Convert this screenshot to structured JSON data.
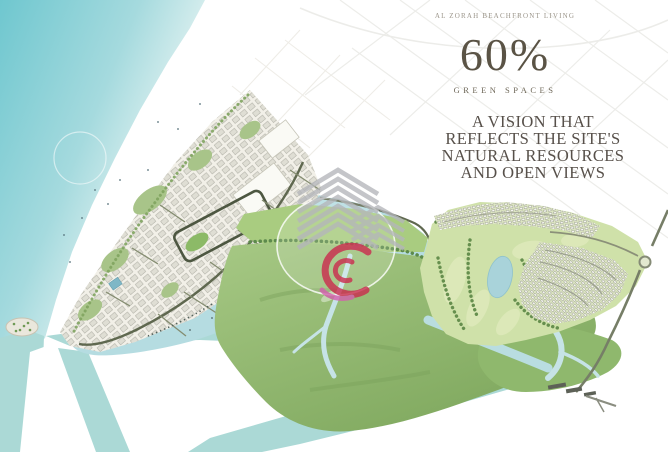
{
  "overlay": {
    "tagline": "AL ZORAH BEACHFRONT LIVING",
    "stat": {
      "value": "60%",
      "label": "GREEN SPACES"
    },
    "vision": {
      "line1": "A VISION THAT",
      "line2": "REFLECTS THE SITE'S",
      "line3": "NATURAL RESOURCES",
      "line4": "AND OPEN VIEWS"
    }
  },
  "watermarks": {
    "gray_building": "chevron-building-logo",
    "red_swirl": "red-swirl-logo"
  },
  "map": {
    "colors": {
      "sea": "#6fc7cf",
      "sea_shallow": "#a5dade",
      "lagoon": "#b5dce1",
      "channel": "#abd9d6",
      "mangrove": "#a6c884",
      "mangrove_dark": "#7fa85e",
      "golf": "#cfe1a9",
      "land": "#f2f0e8",
      "road": "#5f684f",
      "text": "#57504a",
      "watermark_gray": "#b4b6ba",
      "watermark_red": "#cb2b4e",
      "watermark_pink": "#d45fae"
    }
  }
}
